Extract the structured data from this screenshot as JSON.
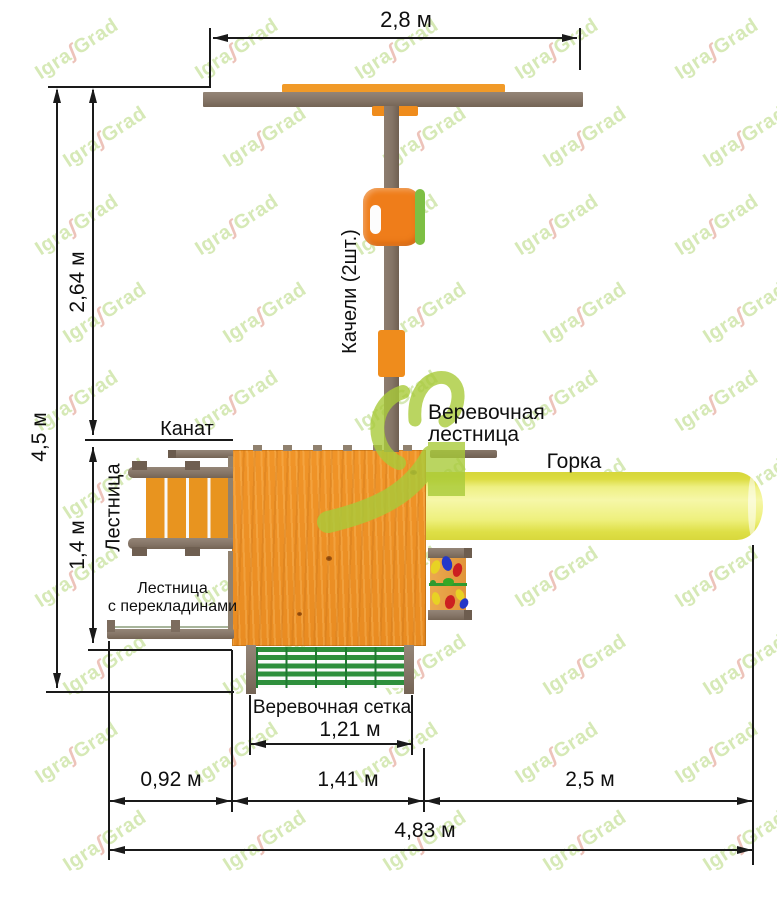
{
  "watermark": {
    "part1": "Igra",
    "swoosh": "ʃ",
    "part2": "Grad"
  },
  "dimensions": {
    "top_width": "2,8 м",
    "left_total": "4,5 м",
    "left_upper": "2,64 м",
    "left_lower": "1,4 м",
    "net_width": "1,21 м",
    "bottom_left": "0,92 м",
    "bottom_middle": "1,41 м",
    "bottom_right": "2,5 м",
    "bottom_total": "4,83 м"
  },
  "labels": {
    "swing": "Качели (2шт.)",
    "rope": "Канат",
    "ladder": "Лестница",
    "rung_ladder_line1": "Лестница",
    "rung_ladder_line2": "с перекладинами",
    "rope_ladder_line1": "Веревочная",
    "rope_ladder_line2": "лестница",
    "slide": "Горка",
    "rope_net": "Веревочная сетка"
  },
  "colors": {
    "wood_frame": "#857567",
    "accent_orange": "#ef8c1c",
    "platform_orange": "#ee9226",
    "slide_yellow": "#eef083",
    "net_green": "#2e8f3c",
    "logo_green": "#a9cb3a",
    "dimension_black": "#1a1a1a",
    "watermark_green": "#d6e9b6",
    "watermark_red": "#edc3ba"
  }
}
